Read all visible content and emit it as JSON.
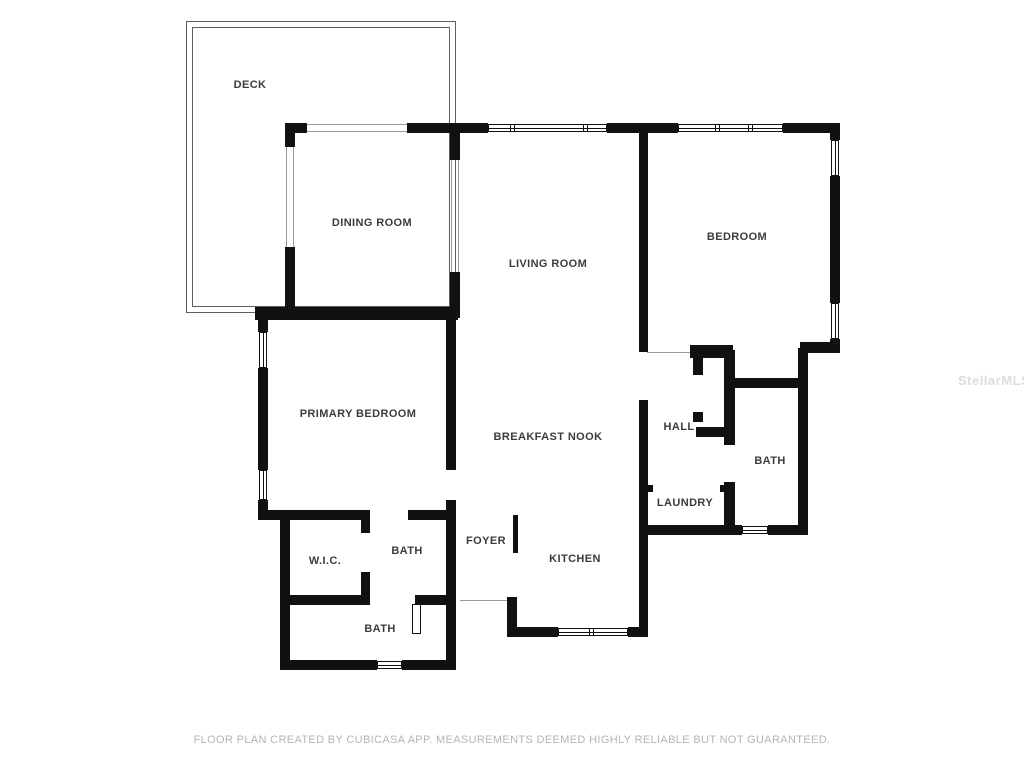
{
  "title": "Floor plan",
  "colors": {
    "background": "#ffffff",
    "wall": "#111111",
    "deck_line": "#5f5f5f",
    "opening_line": "#9a9a9a",
    "label": "#3c3c3c",
    "footer": "#b5b5b5",
    "watermark": "#dcdcdc"
  },
  "watermark": {
    "text": "StellarMLS",
    "x": 958,
    "y": 373
  },
  "footer": {
    "text": "FLOOR PLAN CREATED BY CUBICASA APP. MEASUREMENTS DEEMED HIGHLY RELIABLE BUT NOT GUARANTEED."
  },
  "floorplan": {
    "rooms": [
      {
        "slug": "deck",
        "label": "DECK",
        "x": 250,
        "y": 85
      },
      {
        "slug": "dining-room",
        "label": "DINING ROOM",
        "x": 372,
        "y": 223
      },
      {
        "slug": "living-room",
        "label": "LIVING ROOM",
        "x": 548,
        "y": 264
      },
      {
        "slug": "bedroom",
        "label": "BEDROOM",
        "x": 737,
        "y": 237
      },
      {
        "slug": "primary-bedroom",
        "label": "PRIMARY BEDROOM",
        "x": 358,
        "y": 414
      },
      {
        "slug": "breakfast-nook",
        "label": "BREAKFAST NOOK",
        "x": 548,
        "y": 437
      },
      {
        "slug": "hall",
        "label": "HALL",
        "x": 679,
        "y": 427
      },
      {
        "slug": "bath-right",
        "label": "BATH",
        "x": 770,
        "y": 461
      },
      {
        "slug": "laundry",
        "label": "LAUNDRY",
        "x": 685,
        "y": 503
      },
      {
        "slug": "wic",
        "label": "W.I.C.",
        "x": 325,
        "y": 561
      },
      {
        "slug": "bath-middle",
        "label": "BATH",
        "x": 407,
        "y": 551
      },
      {
        "slug": "foyer",
        "label": "FOYER",
        "x": 486,
        "y": 541
      },
      {
        "slug": "kitchen",
        "label": "KITCHEN",
        "x": 575,
        "y": 559
      },
      {
        "slug": "bath-bottom",
        "label": "BATH",
        "x": 380,
        "y": 629
      }
    ],
    "deck": {
      "outer": {
        "x": 186,
        "y": 21,
        "w": 270,
        "h": 292
      },
      "inner": {
        "x": 192,
        "y": 27,
        "w": 258,
        "h": 280
      }
    },
    "walls": [
      [
        285,
        123,
        22,
        10
      ],
      [
        407,
        123,
        81,
        10
      ],
      [
        607,
        123,
        71,
        10
      ],
      [
        783,
        123,
        57,
        10
      ],
      [
        830,
        123,
        10,
        17
      ],
      [
        830,
        176,
        10,
        127
      ],
      [
        830,
        339,
        10,
        14
      ],
      [
        800,
        342,
        40,
        11
      ],
      [
        798,
        348,
        10,
        40
      ],
      [
        798,
        388,
        10,
        147
      ],
      [
        639,
        525,
        103,
        10
      ],
      [
        768,
        525,
        40,
        10
      ],
      [
        507,
        627,
        51,
        10
      ],
      [
        628,
        627,
        20,
        10
      ],
      [
        507,
        597,
        10,
        40
      ],
      [
        446,
        500,
        10,
        170
      ],
      [
        446,
        310,
        10,
        160
      ],
      [
        280,
        660,
        97,
        10
      ],
      [
        402,
        660,
        54,
        10
      ],
      [
        280,
        510,
        10,
        160
      ],
      [
        258,
        510,
        110,
        10
      ],
      [
        408,
        510,
        48,
        10
      ],
      [
        258,
        307,
        10,
        25
      ],
      [
        258,
        368,
        10,
        102
      ],
      [
        258,
        500,
        10,
        20
      ],
      [
        255,
        307,
        203,
        13
      ],
      [
        285,
        123,
        10,
        24
      ],
      [
        285,
        247,
        10,
        71
      ],
      [
        450,
        123,
        10,
        37
      ],
      [
        450,
        272,
        10,
        46
      ],
      [
        280,
        595,
        90,
        10
      ],
      [
        415,
        595,
        41,
        10
      ],
      [
        361,
        510,
        9,
        23
      ],
      [
        361,
        572,
        9,
        33
      ],
      [
        513,
        515,
        5,
        38
      ],
      [
        639,
        123,
        9,
        229
      ],
      [
        639,
        400,
        9,
        237
      ],
      [
        639,
        485,
        14,
        7
      ],
      [
        720,
        485,
        15,
        7
      ],
      [
        724,
        350,
        11,
        95
      ],
      [
        724,
        482,
        11,
        45
      ],
      [
        733,
        378,
        75,
        10
      ],
      [
        690,
        345,
        43,
        13
      ],
      [
        693,
        350,
        10,
        25
      ],
      [
        693,
        412,
        10,
        10
      ],
      [
        696,
        427,
        34,
        10
      ]
    ],
    "windows": [
      {
        "x": 488,
        "y": 124,
        "w": 119,
        "h": 8,
        "dir": "h",
        "mullions": [
          24,
          97
        ]
      },
      {
        "x": 678,
        "y": 124,
        "w": 105,
        "h": 8,
        "dir": "h",
        "mullions": [
          39,
          72
        ]
      },
      {
        "x": 831,
        "y": 140,
        "w": 8,
        "h": 36,
        "dir": "v",
        "mullions": []
      },
      {
        "x": 831,
        "y": 303,
        "w": 8,
        "h": 36,
        "dir": "v",
        "mullions": []
      },
      {
        "x": 259,
        "y": 332,
        "w": 8,
        "h": 36,
        "dir": "v",
        "mullions": []
      },
      {
        "x": 259,
        "y": 470,
        "w": 8,
        "h": 30,
        "dir": "v",
        "mullions": []
      },
      {
        "x": 742,
        "y": 526,
        "w": 26,
        "h": 8,
        "dir": "h",
        "mullions": []
      },
      {
        "x": 558,
        "y": 628,
        "w": 70,
        "h": 8,
        "dir": "h",
        "mullions": [
          33
        ]
      },
      {
        "x": 377,
        "y": 661,
        "w": 25,
        "h": 8,
        "dir": "h",
        "mullions": []
      }
    ],
    "openings": [
      [
        307,
        124,
        100,
        1
      ],
      [
        307,
        131,
        100,
        1
      ],
      [
        286,
        147,
        1,
        100
      ],
      [
        293,
        147,
        1,
        100
      ],
      [
        451,
        160,
        1,
        112
      ],
      [
        458,
        160,
        1,
        112
      ],
      [
        647,
        352,
        43,
        1
      ],
      [
        460,
        600,
        47,
        1
      ]
    ],
    "door_leaves": [
      [
        412,
        604,
        9,
        30
      ]
    ]
  }
}
